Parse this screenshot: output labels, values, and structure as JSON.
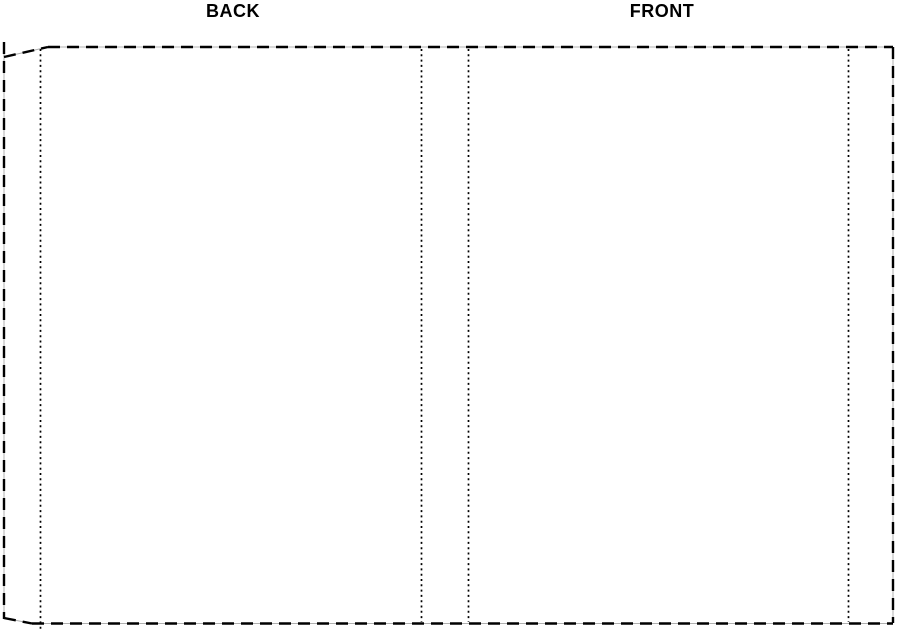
{
  "diagram": {
    "back_label": "BACK",
    "front_label": "FRONT"
  },
  "colors": {
    "background": "#ffffff",
    "line": "#000000",
    "underlay": "#b0b0b0",
    "text": "#000000"
  }
}
